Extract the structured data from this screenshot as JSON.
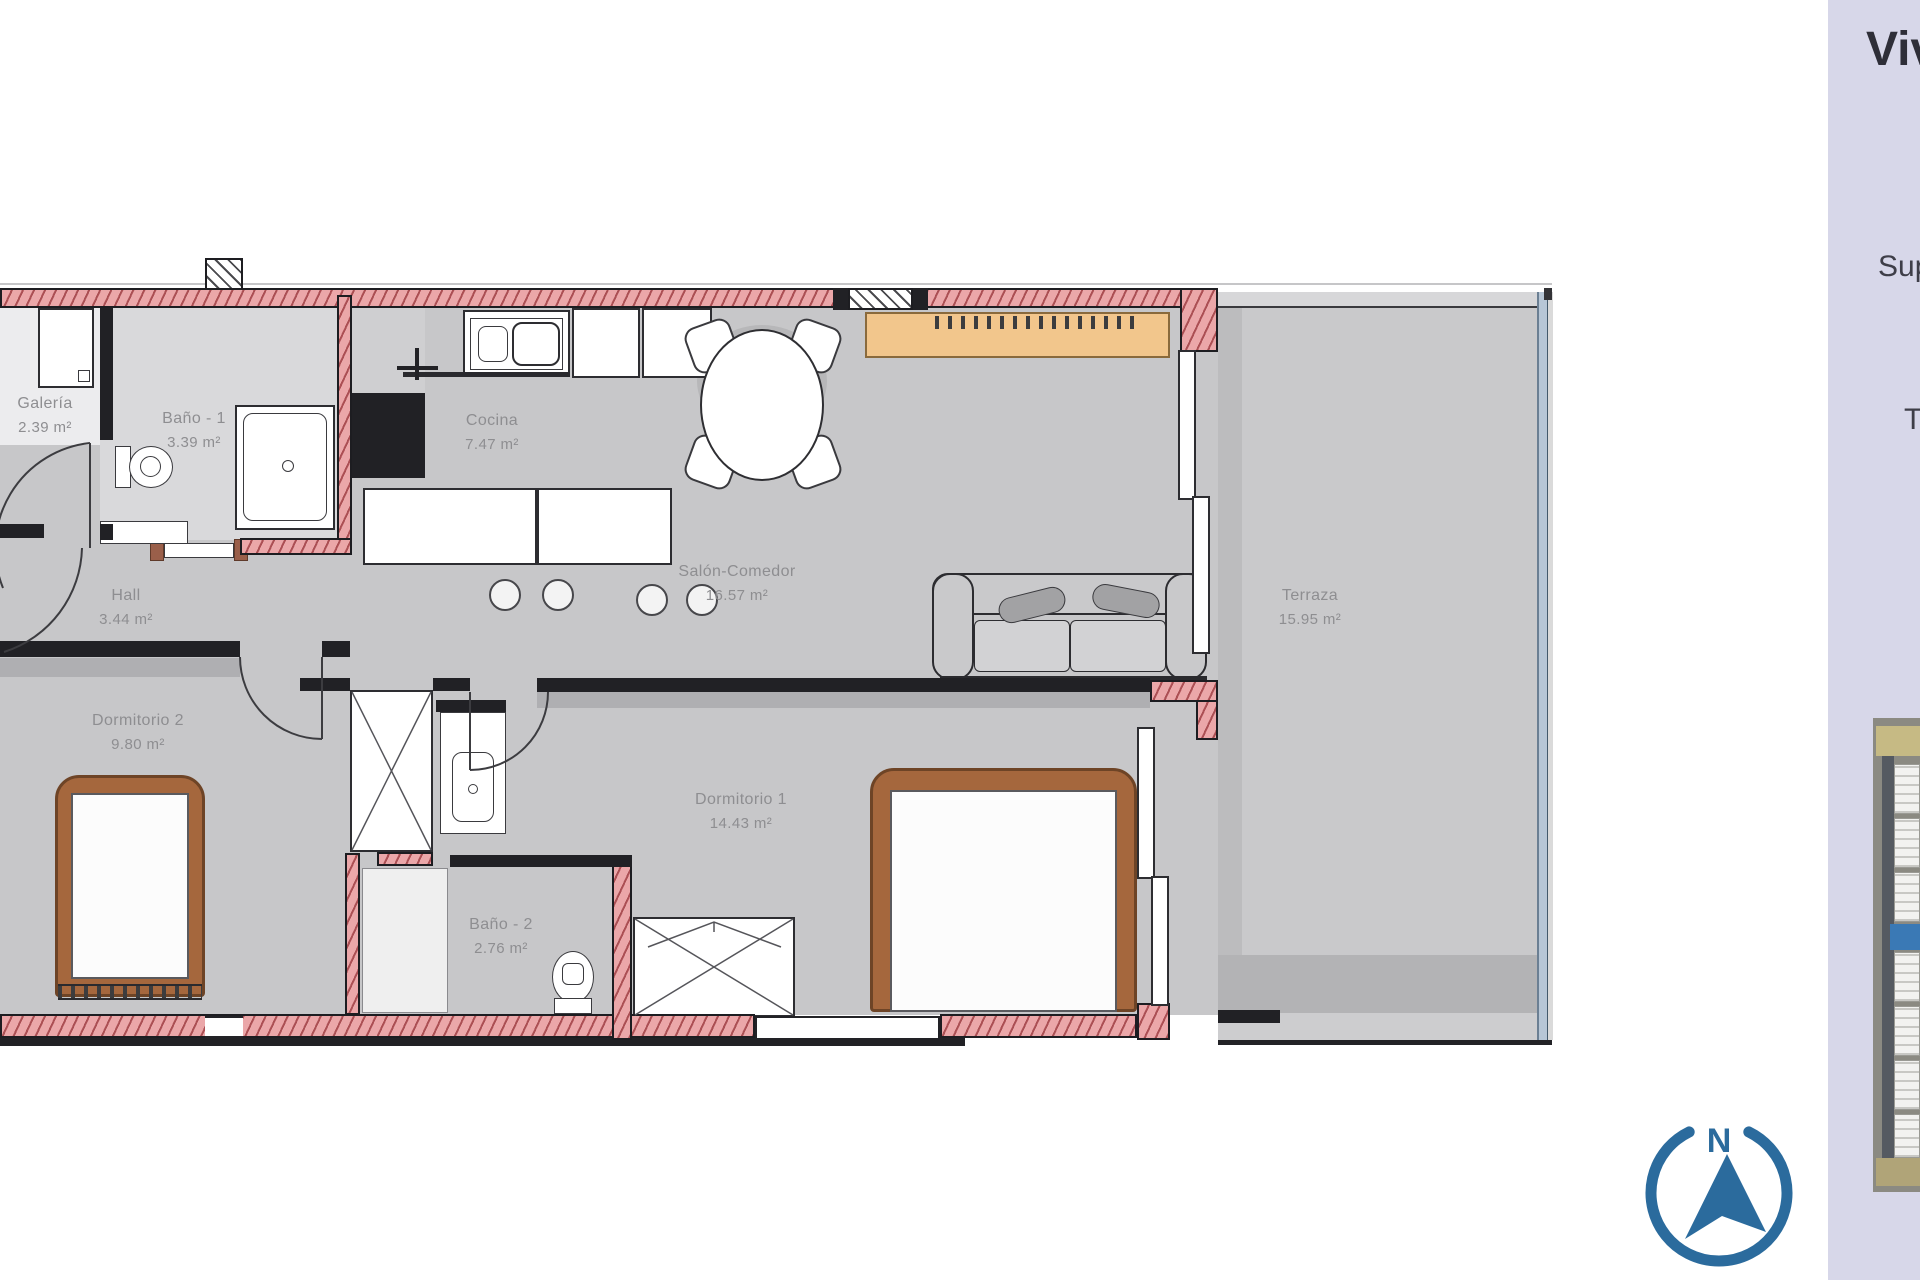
{
  "plan": {
    "rooms": {
      "galeria": {
        "name": "Galería",
        "area": "2.39 m²"
      },
      "bano1": {
        "name": "Baño - 1",
        "area": "3.39 m²"
      },
      "cocina": {
        "name": "Cocina",
        "area": "7.47 m²"
      },
      "hall": {
        "name": "Hall",
        "area": "3.44 m²"
      },
      "salon": {
        "name": "Salón-Comedor",
        "area": "16.57 m²"
      },
      "dorm2": {
        "name": "Dormitorio 2",
        "area": "9.80 m²"
      },
      "dorm1": {
        "name": "Dormitorio 1",
        "area": "14.43 m²"
      },
      "bano2": {
        "name": "Baño - 2",
        "area": "2.76 m²"
      },
      "terraza": {
        "name": "Terraza",
        "area": "15.95 m²"
      }
    },
    "colors": {
      "wall_pink": "#eba7a9",
      "wall_hatch": "#963237",
      "floor_gray": "#c7c7c9",
      "terrace_glass": "#b7c6d6",
      "wood_brown": "#a5673d",
      "sideboard_orange": "#f2c68c",
      "label_gray": "#8e8e91"
    }
  },
  "sidebar": {
    "background": "#d7d7e9",
    "title_partial": "Viv",
    "superficie_partial": "Sup",
    "terraza_partial": "T"
  },
  "compass": {
    "label": "N",
    "color": "#2b6b9d"
  }
}
